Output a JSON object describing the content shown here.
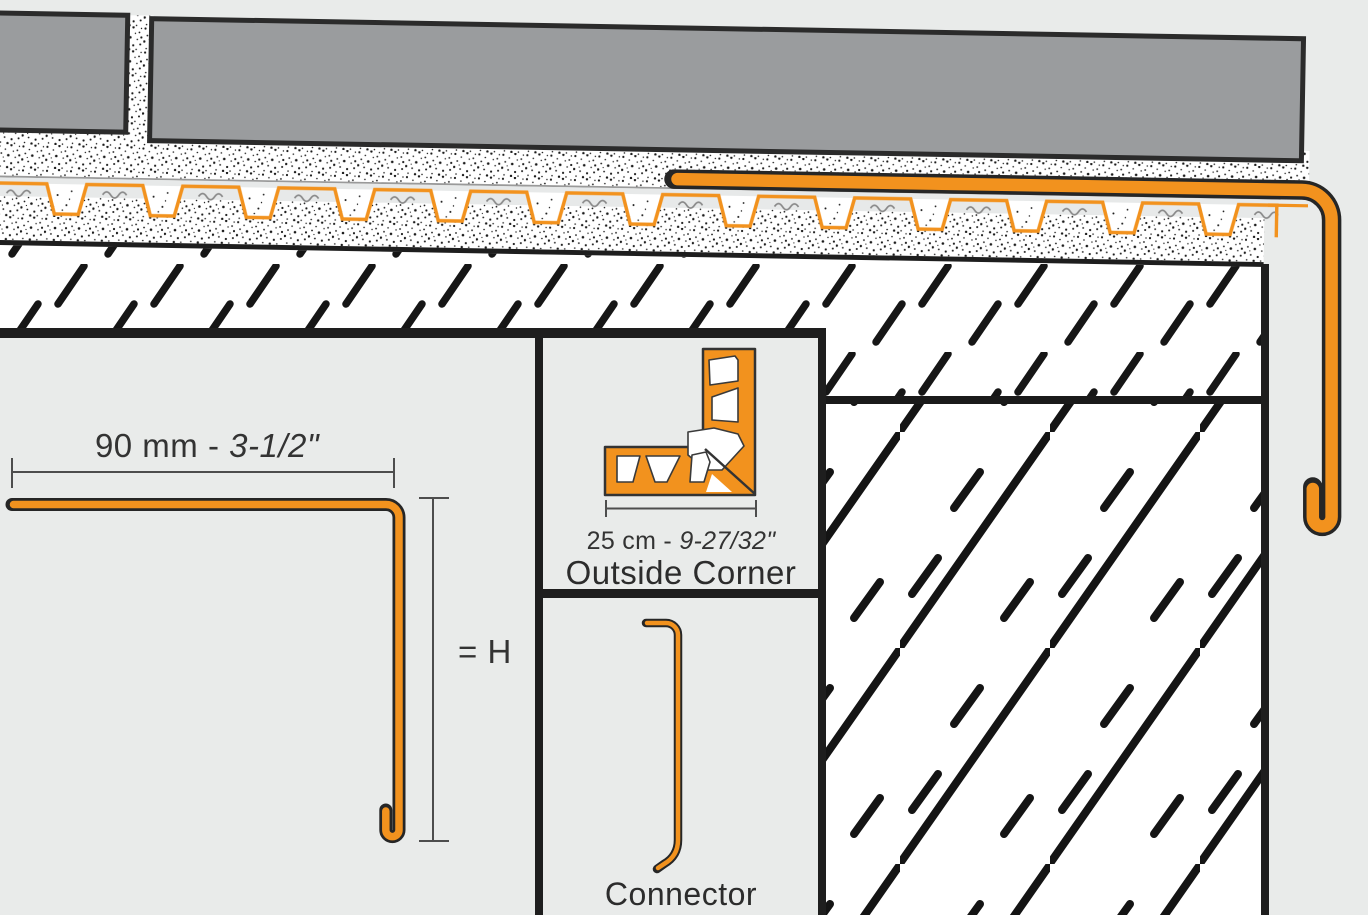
{
  "labels": {
    "main_dimension": {
      "prefix": "90 mm - ",
      "imperial": "3-1/2\""
    },
    "height_dimension": "= H",
    "outside_corner": {
      "dim_prefix": "25 cm - ",
      "dim_imperial": "9-27/32\"",
      "caption": "Outside Corner"
    },
    "connector": {
      "caption": "Connector"
    }
  },
  "colors": {
    "profile_orange": "#F2921E",
    "tile_gray": "#9A9C9E",
    "outline_black": "#262626",
    "background_gray": "#E9EBEA",
    "mat_gray": "#E7E9E9",
    "dimension_line_gray": "#4D4D4D",
    "text_gray": "#333333"
  }
}
